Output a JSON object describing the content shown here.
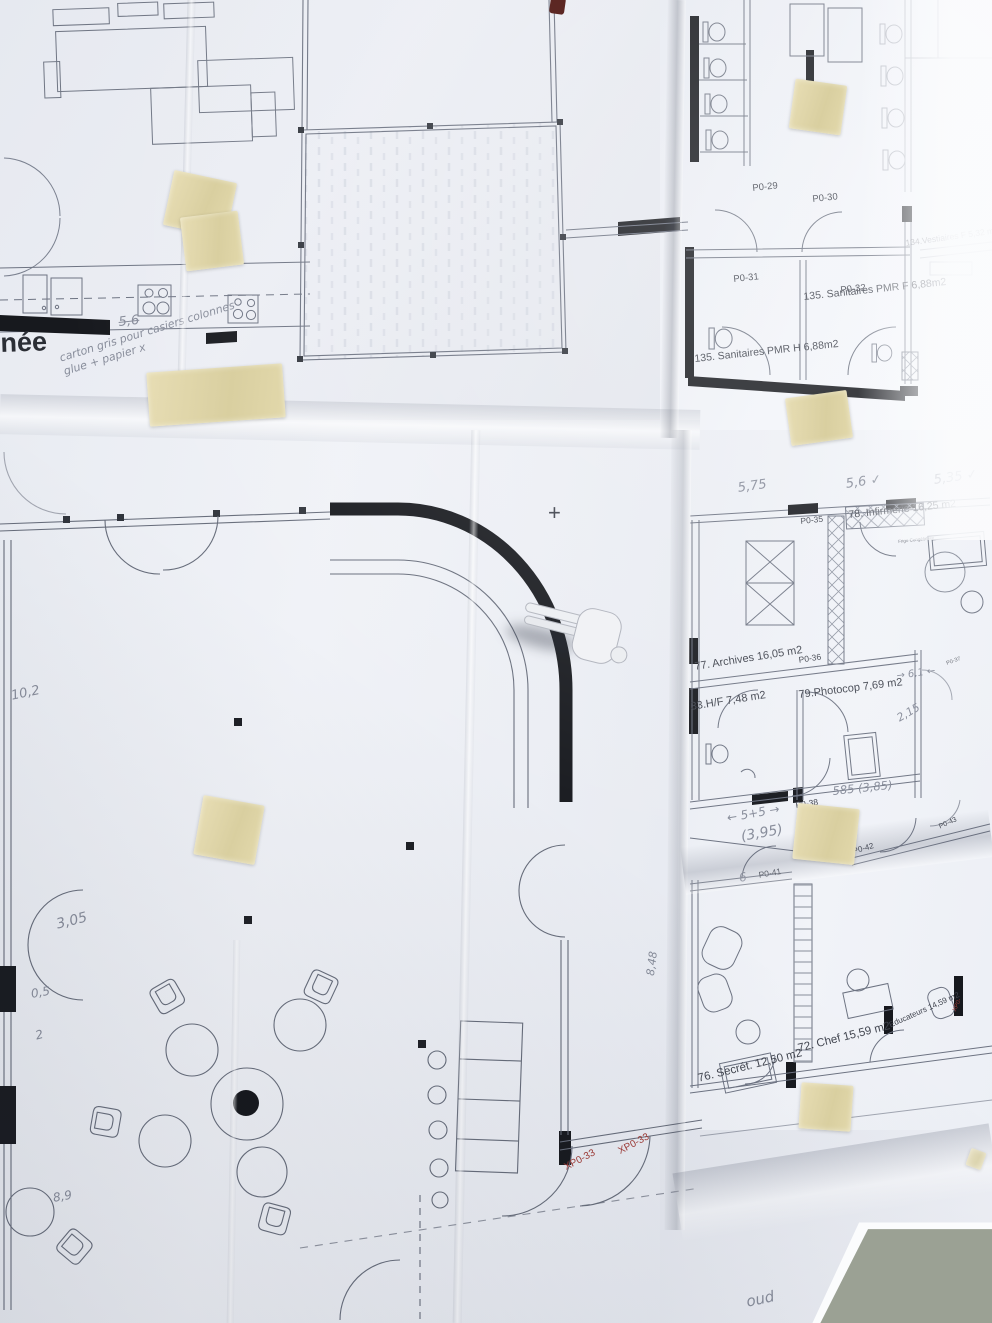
{
  "colors": {
    "wall": "#a8aea0",
    "paper": "#e9ecf2",
    "tape": "#ddd3a6",
    "print_ink": "#41454f",
    "wall_poche": "#17191e",
    "red_label": "#a03b36",
    "pencil": "#878c9a"
  },
  "top_left_sheet": {
    "title_fragment": "née",
    "note_handwritten": "carton gris pour casiers colonnes glue + papier x",
    "dim_handwritten": "5,6"
  },
  "top_right_sheet": {
    "door_labels": [
      "P0-29",
      "P0-30",
      "P0-31",
      "P0-32"
    ],
    "room_labels": [
      "134.Vestiaires F 5,32 m2",
      "135. Sanitaires PMR F 6,88m2",
      "135. Sanitaires PMR H 6,88m2"
    ]
  },
  "left_plan_sheet": {
    "door_labels": [
      "XP0-33",
      "XP0-33"
    ],
    "handwritten": [
      "10,2",
      "3,05",
      "0,5",
      "2",
      "8,9"
    ],
    "edge_text": "30 30"
  },
  "right_plan_sheet": {
    "door_labels": [
      "P0-35",
      "P0-36",
      "P0-37",
      "P0-38",
      "P0-41",
      "P0-42",
      "P0-43"
    ],
    "red_door_label": "XP0-",
    "room_labels": [
      "78. Infirmerie 16,25 m2",
      "77. Archives 16,05 m2",
      "33.H/F 7,48 m2",
      "79.Photocop 7,69 m2",
      "76. Secrét. 12,50 m2",
      "72. Chef 15,59 m2",
      "Educateurs 14,59 m2"
    ],
    "tiny_label": "Frigo Congélateur",
    "handwritten": [
      "5,75",
      "5,6 ✓",
      "5,35 ✓",
      "→ 6,1 ←",
      "2,15",
      "585 (3,85)",
      "← 5+5 →",
      "(3,95)",
      "6",
      "8,48"
    ]
  },
  "marks": {
    "plus": "+",
    "bottom_scribble": "oud"
  }
}
